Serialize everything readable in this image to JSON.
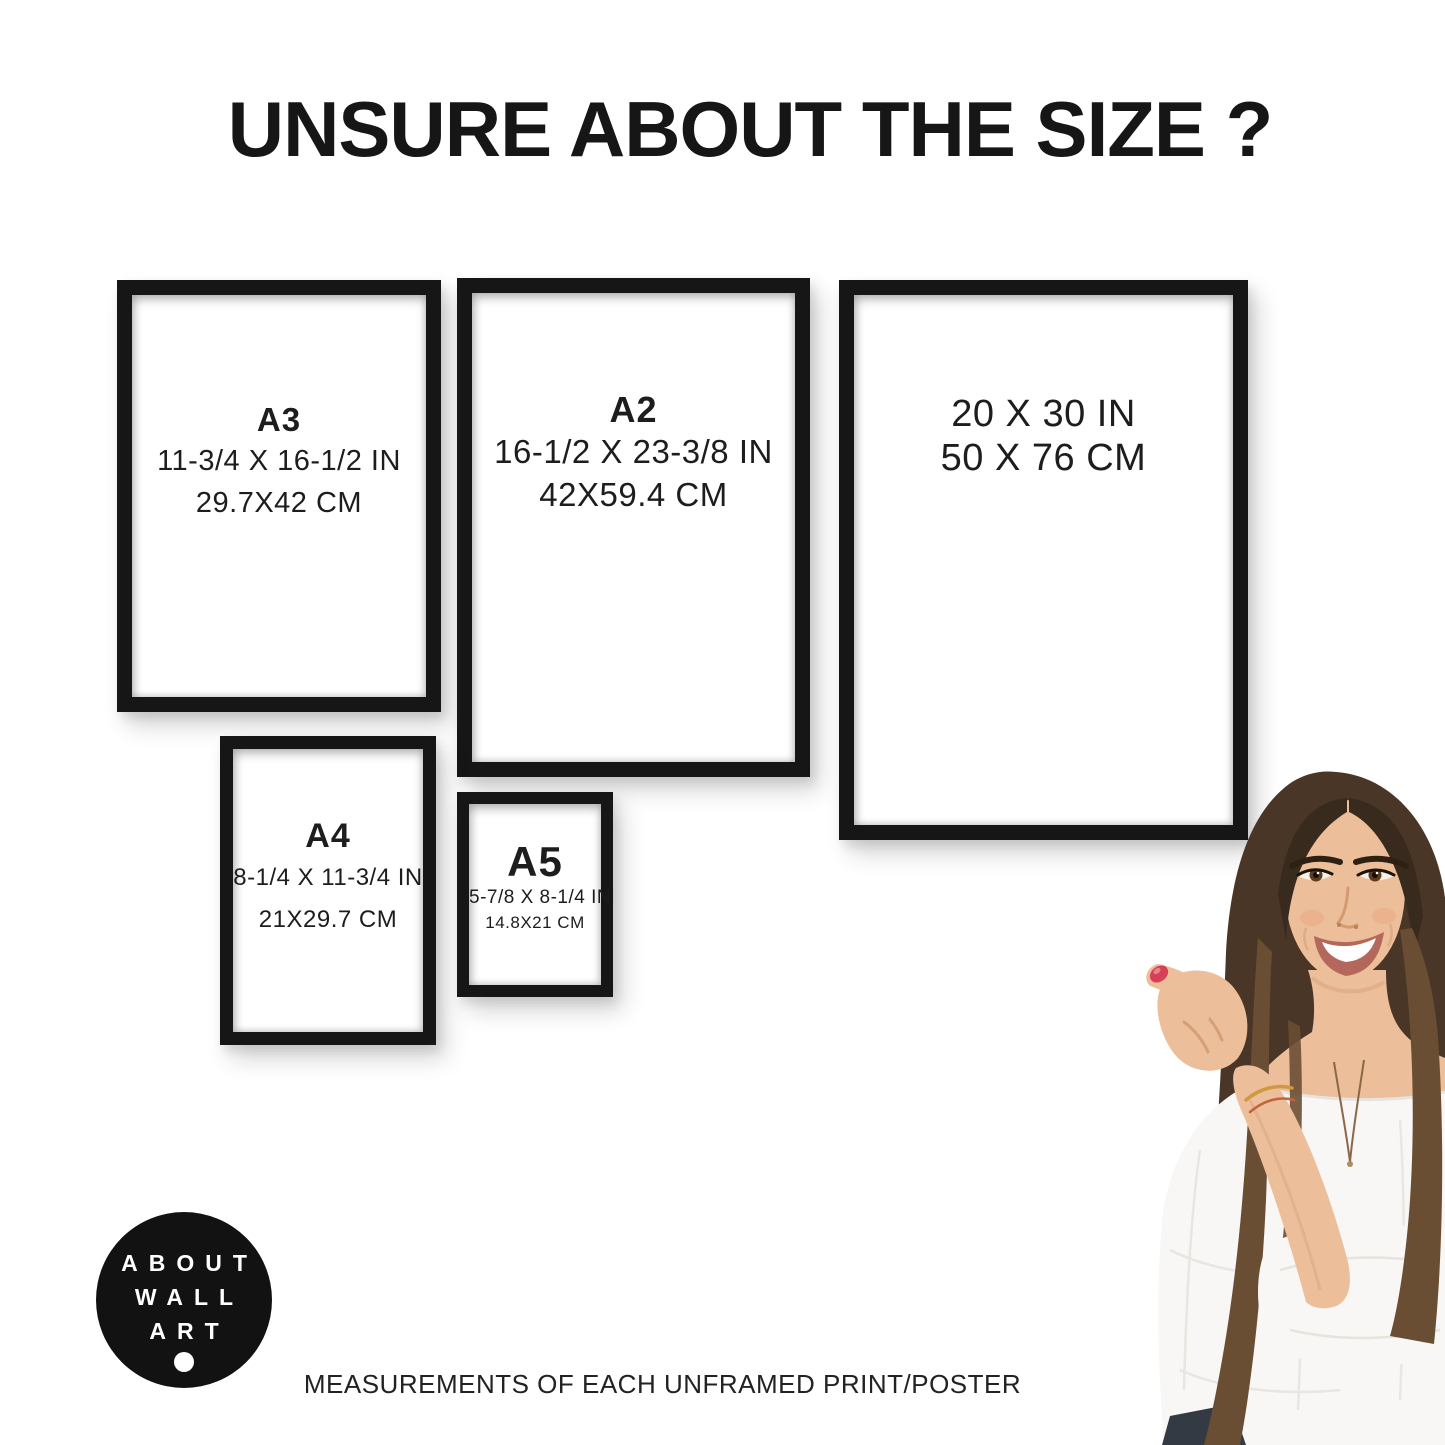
{
  "page": {
    "title": "UNSURE ABOUT THE SIZE ?",
    "caption": "MEASUREMENTS OF EACH UNFRAMED PRINT/POSTER"
  },
  "frames": [
    {
      "name": "A3",
      "label": "A3",
      "inches": "11-3/4 X 16-1/2 IN",
      "centimeters": "29.7X42 CM"
    },
    {
      "name": "A2",
      "label": "A2",
      "inches": "16-1/2 X 23-3/8 IN",
      "centimeters": "42X59.4 CM"
    },
    {
      "name": "20x30",
      "label": "",
      "inches": "20 X 30 IN",
      "centimeters": "50 X 76 CM"
    },
    {
      "name": "A4",
      "label": "A4",
      "inches": "8-1/4 X 11-3/4 IN",
      "centimeters": "21X29.7 CM"
    },
    {
      "name": "A5",
      "label": "A5",
      "inches": "5-7/8 X 8-1/4 IN",
      "centimeters": "14.8X21 CM"
    }
  ],
  "logo": {
    "lines": [
      "ABOUT",
      "WALL",
      "ART"
    ]
  },
  "colors": {
    "frame_border": "#161616",
    "text": "#1d1d1d",
    "logo_bg": "#121212",
    "logo_text": "#ffffff",
    "hair": "#4a3627",
    "hair_light": "#6a4e33",
    "hair_dark": "#382a1c",
    "skin": "#ecbe9a",
    "skin_shadow": "#d69f78",
    "blouse": "#f8f7f5",
    "blouse_shadow": "#e7e3dd",
    "nail": "#d84058",
    "lips": "#b4685c",
    "jeans": "#333a43",
    "bracelet": "#cf9942"
  }
}
